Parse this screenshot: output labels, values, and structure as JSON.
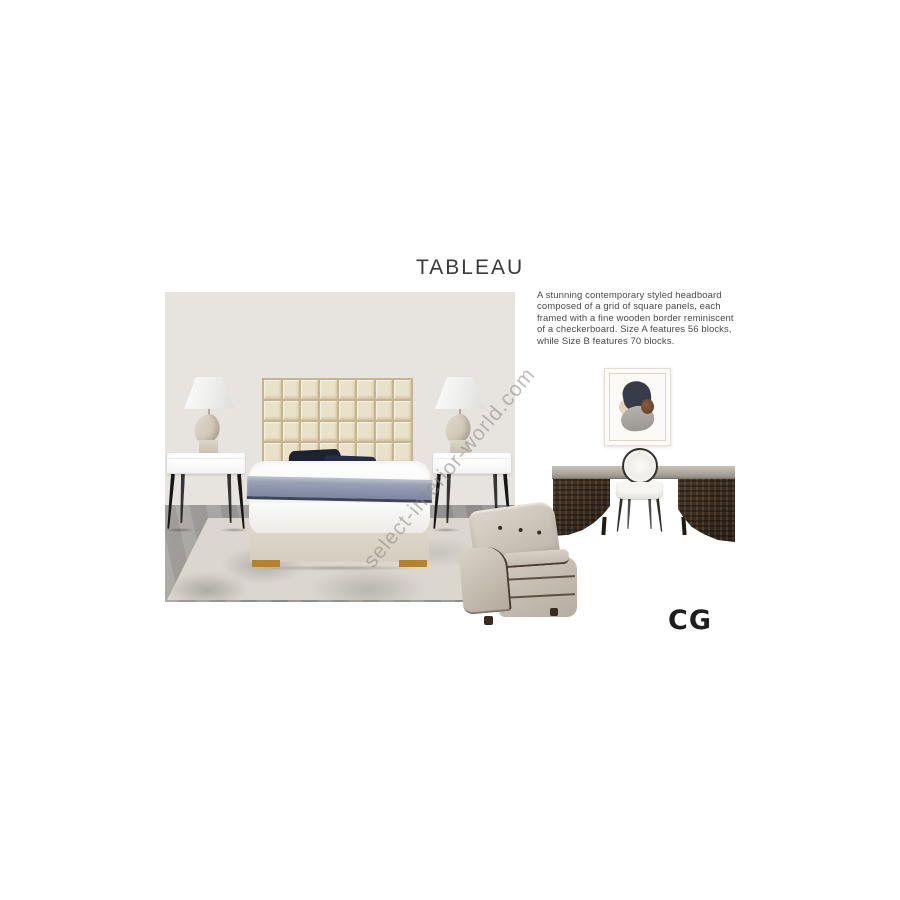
{
  "texts": {
    "title": "TABLEAU",
    "description": "A stunning contemporary styled headboard composed of a grid of square panels, each framed with a fine wooden border reminiscent of a checkerboard. Size A features 56 blocks, while Size B features 70 blocks.",
    "watermark": "select-interior-world.com",
    "logo": "CG"
  },
  "headboard": {
    "grid_columns": 8,
    "grid_rows": 7,
    "size_a_blocks": 56,
    "size_b_blocks": 70
  },
  "colors": {
    "ink": "#3a3a3a",
    "wall": "#e7e4e0",
    "rug": "#dcd7ce",
    "rug_patch": "#b3b0aa",
    "hb_panel": "#eae1cb",
    "hb_gap": "#c7b38c",
    "pillow_navy": "#1d2233",
    "throw_blue": "#8f97ae",
    "throw_edge": "#3f465c",
    "bed_base": "#ddd6c8",
    "gold": "#b5812d",
    "night_white": "#fdfdfd",
    "leg_black": "#161616",
    "seat_white": "#f7f6f3",
    "frame_dark": "#35322e",
    "armchair_dark": "#4a3e33",
    "art_navy": "#373c48",
    "art_cream": "#e3d5ba",
    "watermark": "#8a8885"
  }
}
